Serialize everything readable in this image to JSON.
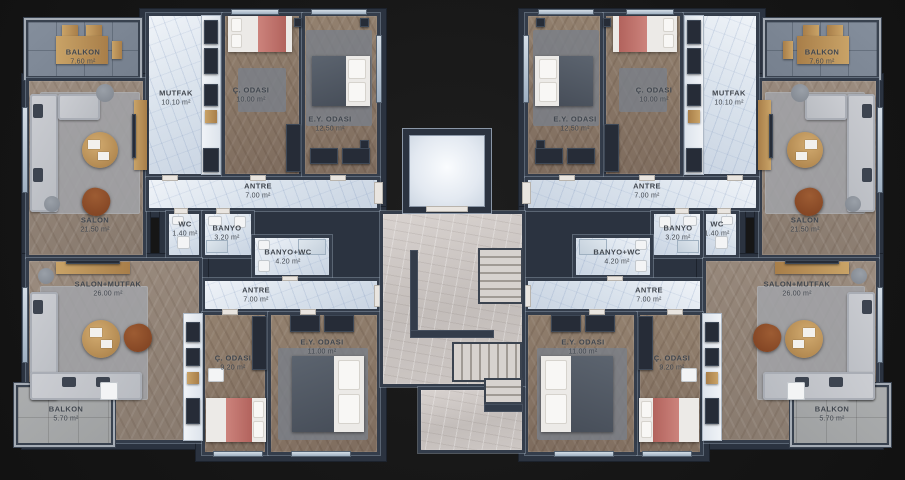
{
  "plan": {
    "type": "residential-floor-plan",
    "wings": 2,
    "flats_per_wing": 2,
    "colors": {
      "background": "#161616",
      "wall": "#333c4a",
      "wall_highlight": "#94a1b2",
      "wood_floor": "#8f8173",
      "bedroom_floor": "#887463",
      "marble_floor": "#dde6ee",
      "corridor_floor": "#cdc7c4",
      "balcony_tile_blue": "#7e8896",
      "balcony_tile_gray": "#a6a8aa",
      "bed_blanket_red": "#bf716b",
      "bed_blanket_dark": "#525a66",
      "sofa": "#c6c9cf",
      "wood_furniture": "#b8905a"
    }
  },
  "labels": {
    "tl_balkon": {
      "name": "BALKON",
      "area": "7.60 m²"
    },
    "tl_mutfak": {
      "name": "MUTFAK",
      "area": "10.10 m²"
    },
    "tl_c_odasi": {
      "name": "Ç. ODASI",
      "area": "10.00 m²"
    },
    "tl_ey_odasi": {
      "name": "E.Y. ODASI",
      "area": "12.50 m²"
    },
    "tl_salon": {
      "name": "SALON",
      "area": "21.50 m²"
    },
    "tl_antre": {
      "name": "ANTRE",
      "area": "7.00 m²"
    },
    "tl_wc": {
      "name": "WC",
      "area": "1.40 m²"
    },
    "tl_banyo": {
      "name": "BANYO",
      "area": "3.20 m²"
    },
    "bl_salon_mutfak": {
      "name": "SALON+MUTFAK",
      "area": "26.00 m²"
    },
    "bl_antre": {
      "name": "ANTRE",
      "area": "7.00 m²"
    },
    "bl_banyo_wc": {
      "name": "BANYO+WC",
      "area": "4.20 m²"
    },
    "bl_c_odasi": {
      "name": "Ç. ODASI",
      "area": "9.20 m²"
    },
    "bl_ey_odasi": {
      "name": "E.Y. ODASI",
      "area": "11.00 m²"
    },
    "bl_balkon": {
      "name": "BALKON",
      "area": "5.70 m²"
    },
    "tr_balkon": {
      "name": "BALKON",
      "area": "7.60 m²"
    },
    "tr_mutfak": {
      "name": "MUTFAK",
      "area": "10.10 m²"
    },
    "tr_c_odasi": {
      "name": "Ç. ODASI",
      "area": "10.00 m²"
    },
    "tr_ey_odasi": {
      "name": "E.Y. ODASI",
      "area": "12.50 m²"
    },
    "tr_salon": {
      "name": "SALON",
      "area": "21.50 m²"
    },
    "tr_antre": {
      "name": "ANTRE",
      "area": "7.00 m²"
    },
    "tr_wc": {
      "name": "WC",
      "area": "1.40 m²"
    },
    "tr_banyo": {
      "name": "BANYO",
      "area": "3.20 m²"
    },
    "br_salon_mutfak": {
      "name": "SALON+MUTFAK",
      "area": "26.00 m²"
    },
    "br_antre": {
      "name": "ANTRE",
      "area": "7.00 m²"
    },
    "br_banyo_wc": {
      "name": "BANYO+WC",
      "area": "4.20 m²"
    },
    "br_c_odasi": {
      "name": "Ç. ODASI",
      "area": "9.20 m²"
    },
    "br_ey_odasi": {
      "name": "E.Y. ODASI",
      "area": "11.00 m²"
    },
    "br_balkon": {
      "name": "BALKON",
      "area": "5.70 m²"
    }
  }
}
